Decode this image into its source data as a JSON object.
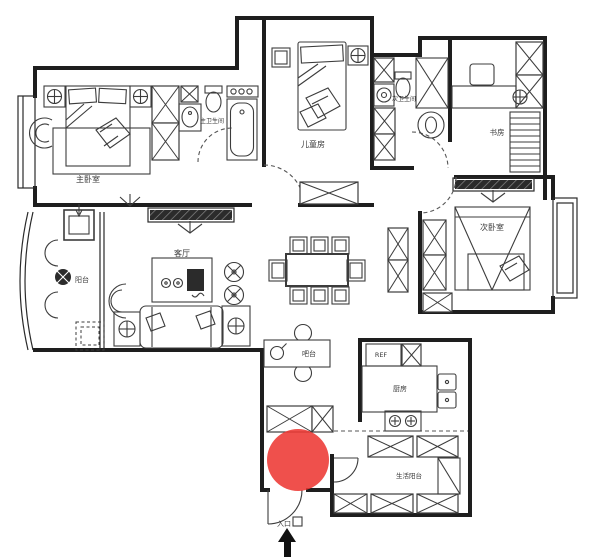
{
  "floor_plan": {
    "background_color": "#ffffff",
    "wall_color": "#1e1e1e",
    "line_color": "#3c3c3c",
    "labels": {
      "master_bedroom": "主卧室",
      "master_bathroom": "主卫生间",
      "kids_room": "儿童房",
      "second_bathroom": "次卫生间",
      "study": "书房",
      "second_bedroom": "次卧室",
      "living_room": "客厅",
      "balcony": "阳台",
      "bar": "吧台",
      "fridge": "REF",
      "kitchen": "厨房",
      "service_balcony": "生活阳台",
      "entrance": "入口"
    },
    "marker": {
      "cx": "298",
      "cy": "460",
      "r": "31",
      "color": "#ed3833",
      "opacity": "0.88"
    }
  }
}
